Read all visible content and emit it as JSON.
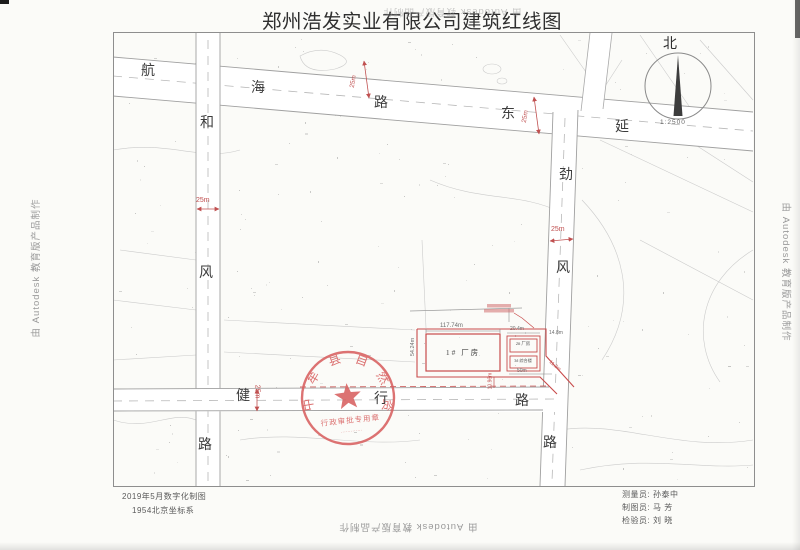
{
  "title": "郑州浩发实业有限公司建筑红线图",
  "watermark_text": "由 Autodesk 教育版产品制作",
  "compass": {
    "north": "北",
    "scale": "1:2500"
  },
  "roads": {
    "hanghai_lu": {
      "name": "航海路",
      "chars": [
        "航",
        "海",
        "路"
      ],
      "extension_chars": [
        "东",
        "延"
      ],
      "width_dim": "25m"
    },
    "hefeng_lu": {
      "name": "和风路",
      "chars": [
        "和",
        "风",
        "路"
      ],
      "width_dim": "25m"
    },
    "jinfeng_lu": {
      "name": "劲风路",
      "chars": [
        "劲",
        "风",
        "路"
      ],
      "width_dim": "25m"
    },
    "jianxing_lu": {
      "name": "健行路",
      "chars": [
        "健",
        "行",
        "路"
      ],
      "width_dim": "25m"
    }
  },
  "site": {
    "building1_label": "1# 厂房",
    "building2_label": "2# 厂房",
    "building3_label": "3# 综合楼",
    "dims": {
      "b1_top": "117.74m",
      "b1_left": "54.24m",
      "cluster_top": "20.4m",
      "cluster_right": "14.8m",
      "cluster_bottom": "50m",
      "corner_diag": "11.2m",
      "road_setback": "10.96m"
    }
  },
  "stamp": {
    "ring_text": "中牟县自然资源局",
    "banner_text": "行政审批专用章",
    "serial_marks": "·············"
  },
  "footer": {
    "left_line1": "2019年5月数字化制图",
    "left_line2": "1954北京坐标系",
    "credits": [
      {
        "label": "测量员:",
        "name": "孙泰中"
      },
      {
        "label": "制图员:",
        "name": "马  芳"
      },
      {
        "label": "检验员:",
        "name": "刘  晓"
      }
    ]
  },
  "colors": {
    "red_line": "#c84b4b",
    "stamp_red": "#d86060",
    "road_edge": "#9e9e9e",
    "ink": "#333333"
  }
}
